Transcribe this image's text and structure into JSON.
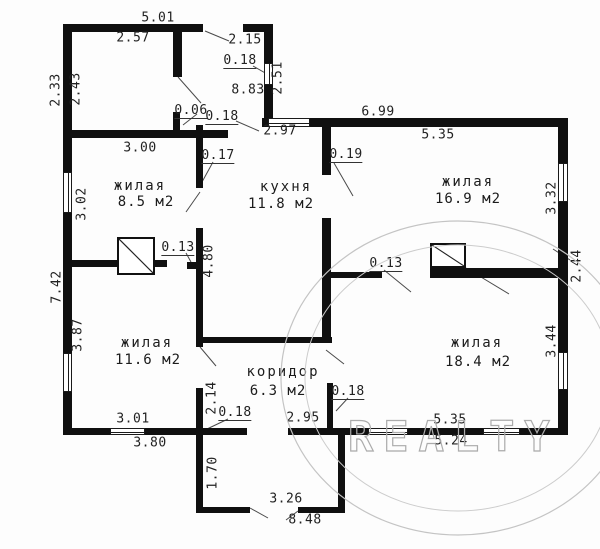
{
  "plan": {
    "type": "floor-plan",
    "language": "ru",
    "units": "m"
  },
  "rooms": [
    {
      "name": "жилая",
      "area": "8.5 м2"
    },
    {
      "name": "кухня",
      "area": "11.8 м2"
    },
    {
      "name": "жилая",
      "area": "16.9 м2"
    },
    {
      "name": "жилая",
      "area": "11.6 м2"
    },
    {
      "name": "коридор",
      "area": "6.3 м2"
    },
    {
      "name": "жилая",
      "area": "18.4 м2"
    }
  ],
  "dims_h": [
    "5.01",
    "2.57",
    "2.15",
    "0.18",
    "8.83",
    "0.06",
    "0.18",
    "2.97",
    "6.99",
    "5.35",
    "3.00",
    "0.17",
    "0.19",
    "0.13",
    "0.13",
    "3.01",
    "0.18",
    "3.80",
    "2.95",
    "0.18",
    "5.35",
    "5.24",
    "3.26",
    "8.48"
  ],
  "dims_v": [
    "2.33",
    "2.43",
    "2.51",
    "3.02",
    "7.42",
    "3.87",
    "4.80",
    "3.32",
    "2.44",
    "3.44",
    "2.14",
    "1.70"
  ],
  "watermark": {
    "text": "REALTY"
  },
  "colors": {
    "wall": "#101010",
    "text": "#222222",
    "watermark": "#ababab",
    "leader": "#4a4a4a"
  }
}
